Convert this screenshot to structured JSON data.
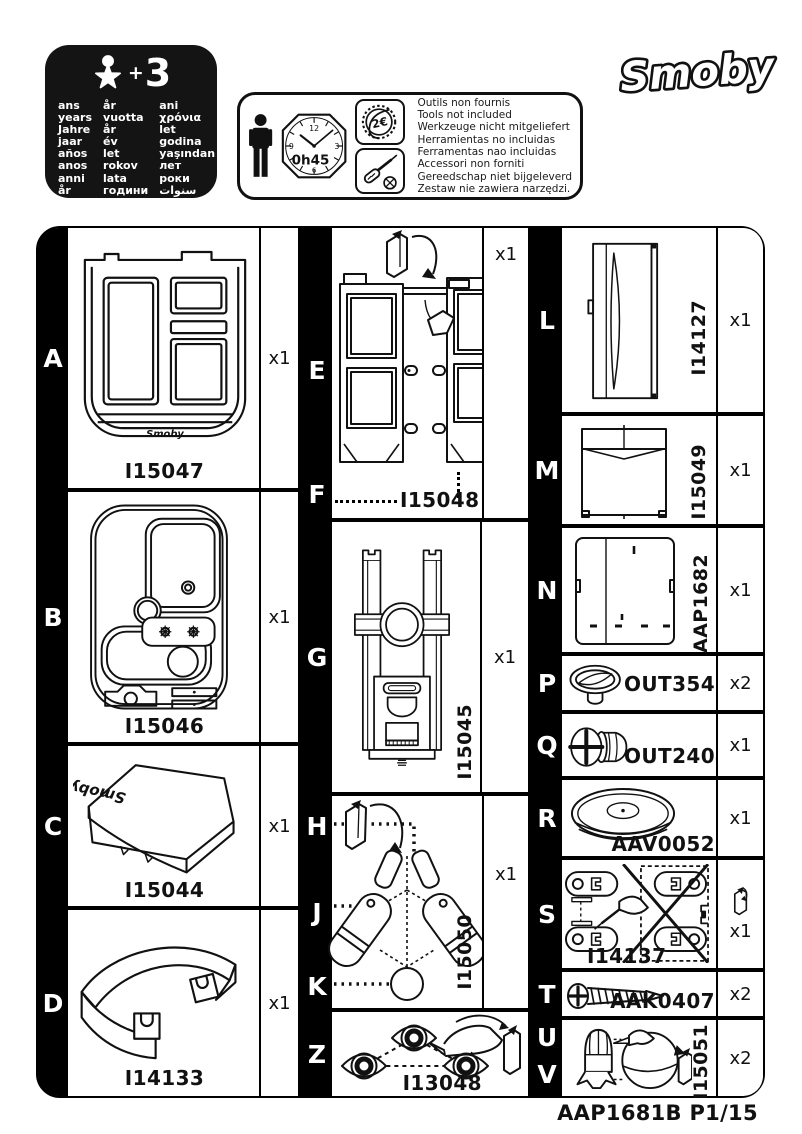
{
  "brand": {
    "logo": "Smoby"
  },
  "age_badge": {
    "plus": "+",
    "number": "3",
    "columns": [
      [
        "ans",
        "years",
        "Jahre",
        "jaar",
        "años",
        "anos",
        "anni",
        "år"
      ],
      [
        "år",
        "vuotta",
        "år",
        "év",
        "let",
        "rokov",
        "lata",
        "години"
      ],
      [
        "ani",
        "χρόνια",
        "let",
        "godina",
        "yaşından",
        "лет",
        "роки",
        "سنوات"
      ]
    ]
  },
  "info_box": {
    "clock": {
      "n12": "12",
      "n3": "3",
      "n6": "6",
      "n9": "9",
      "duration": "0h45"
    },
    "coin": "2€",
    "notes": [
      "Outils non fournis",
      "Tools not included",
      "Werkzeuge nicht mitgeliefert",
      "Herramientas no incluidas",
      "Ferramentas nao incluidas",
      "Accessori non forniti",
      "Gereedschap niet bijgeleverd",
      "Zestaw nie zawiera narzędzi."
    ]
  },
  "sections": {
    "A": {
      "letter": "A",
      "code": "I15047",
      "qty": "x1"
    },
    "B": {
      "letter": "B",
      "code": "I15046",
      "qty": "x1"
    },
    "C": {
      "letter": "C",
      "code": "I15044",
      "qty": "x1"
    },
    "D": {
      "letter": "D",
      "code": "I14133",
      "qty": "x1"
    },
    "EF": {
      "letters": [
        "E",
        "F"
      ],
      "code": "I15048",
      "qty": "x1"
    },
    "G": {
      "letter": "G",
      "code": "I15045",
      "qty": "x1"
    },
    "HJK": {
      "letters": [
        "H",
        "J",
        "K"
      ],
      "code": "I15050",
      "qty": "x1"
    },
    "Z": {
      "letter": "Z",
      "code": "I13048"
    },
    "L": {
      "letter": "L",
      "code": "I14127",
      "qty": "x1"
    },
    "M": {
      "letter": "M",
      "code": "I15049",
      "qty": "x1"
    },
    "N": {
      "letter": "N",
      "code": "AAP1682",
      "qty": "x1"
    },
    "P": {
      "letter": "P",
      "code": "OUT3547",
      "qty": "x2"
    },
    "Q": {
      "letter": "Q",
      "code": "OUT2404",
      "qty": "x1"
    },
    "R": {
      "letter": "R",
      "code": "AAV0052",
      "qty": "x1"
    },
    "S": {
      "letter": "S",
      "code": "I14137",
      "qty": "x1"
    },
    "T": {
      "letter": "T",
      "code": "AAK0407",
      "qty": "x2"
    },
    "UV": {
      "letters": [
        "U",
        "V"
      ],
      "code": "I15051",
      "qty": "x2"
    }
  },
  "footer": {
    "code": "AAP1681B P1/15"
  }
}
